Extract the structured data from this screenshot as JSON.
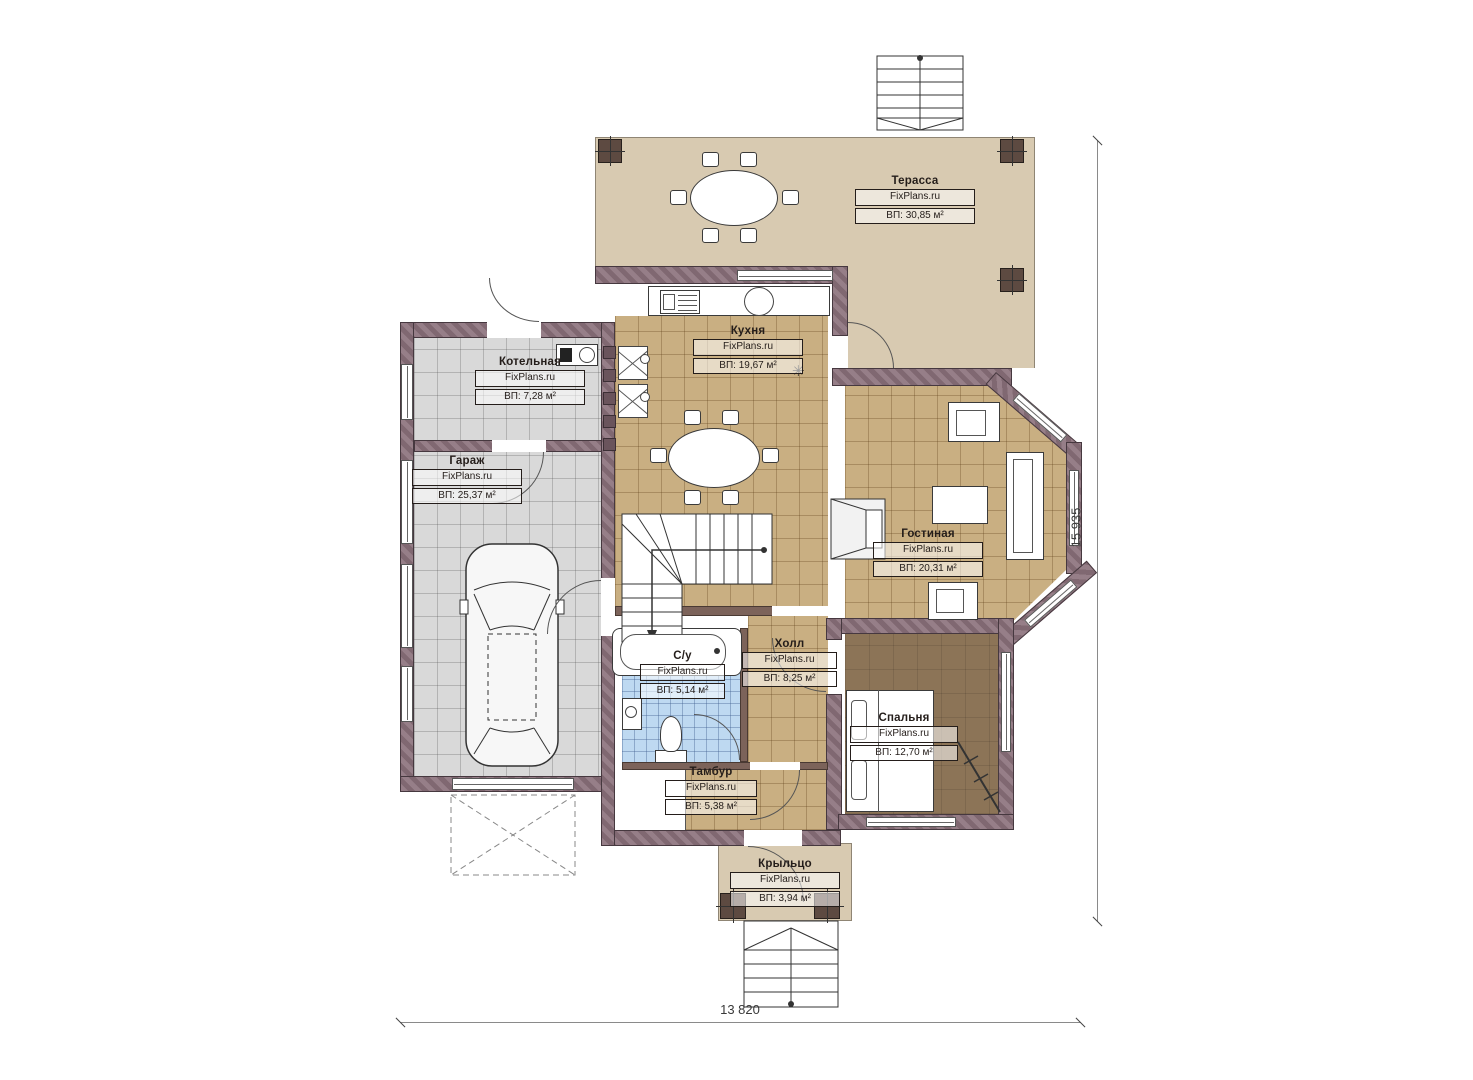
{
  "plan": {
    "brand": "FixPlans.ru",
    "rooms": {
      "terrace": {
        "name": "Терасса",
        "area": "ВП: 30,85 м²"
      },
      "kitchen": {
        "name": "Кухня",
        "area": "ВП: 19,67 м²"
      },
      "boiler": {
        "name": "Котельная",
        "area": "ВП: 7,28 м²"
      },
      "garage": {
        "name": "Гараж",
        "area": "ВП: 25,37 м²"
      },
      "living": {
        "name": "Гостиная",
        "area": "ВП: 20,31 м²"
      },
      "bathroom": {
        "name": "С/у",
        "area": "ВП: 5,14 м²"
      },
      "hall": {
        "name": "Холл",
        "area": "ВП: 8,25 м²"
      },
      "bedroom": {
        "name": "Спальня",
        "area": "ВП: 12,70 м²"
      },
      "vestibule": {
        "name": "Тамбур",
        "area": "ВП: 5,38 м²"
      },
      "porch": {
        "name": "Крыльцо",
        "area": "ВП: 3,94 м²"
      }
    },
    "dimensions": {
      "width": "13 820",
      "height": "15 935"
    },
    "symbols": {
      "boiler_unit": "✳"
    },
    "colors": {
      "wall": "#8a707a",
      "terrace_floor": "#d8cab1",
      "tile_floor": "#c9af82",
      "garage_floor": "#d9d9d9",
      "bath_floor": "#bed9f1",
      "bedroom_floor": "#8c7457",
      "column": "#5d4a41",
      "background": "#ffffff"
    }
  }
}
